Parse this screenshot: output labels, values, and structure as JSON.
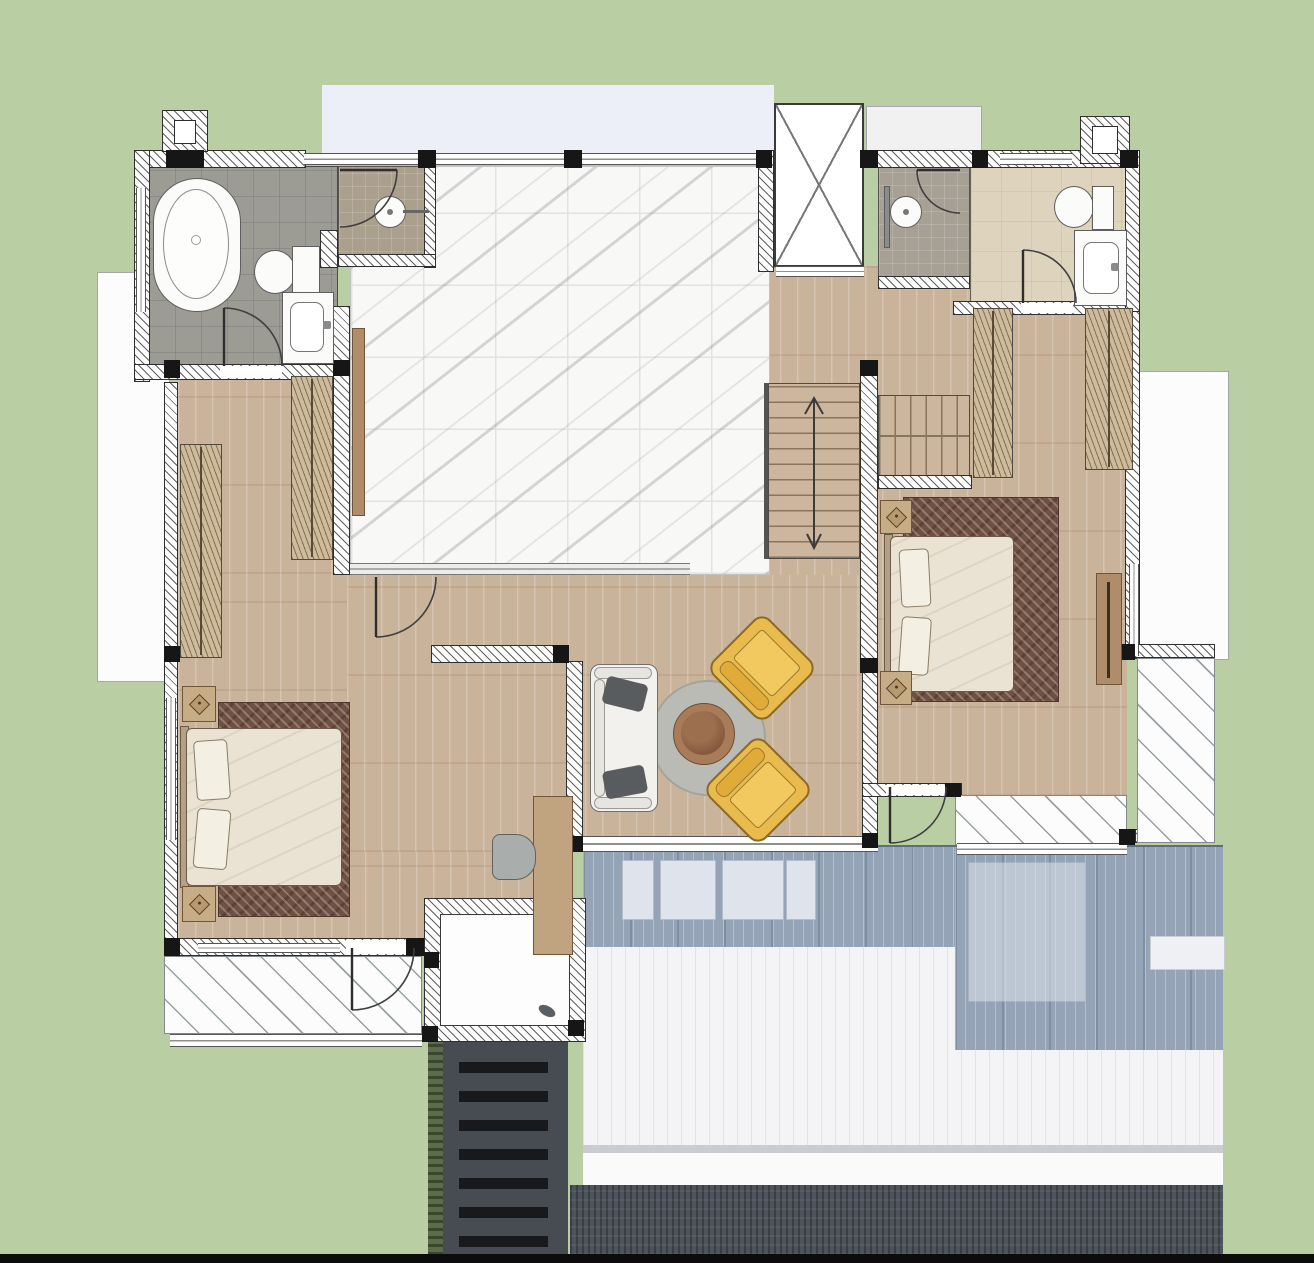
{
  "meta": {
    "type": "architectural-floor-plan",
    "view": "top-down rendered color plan",
    "visible_text": "none",
    "canvas": {
      "width": 1314,
      "height": 1263
    }
  },
  "palette": {
    "background_green": "#b9cea3",
    "pale_roof_lavender": "#edeff8",
    "wood_floor": "#c9b49b",
    "marble_tile": "#f8f8f7",
    "gray_bath_tile": "#9c9c95",
    "tan_shower_tile": "#ab9f8d",
    "beige_bath_floor": "#ded3bc",
    "wall_hatch_line": "#2e2e2e",
    "column_black": "#161616",
    "deck_blue_gray": "#94a4b6",
    "white_roof": "#f4f4f6",
    "dark_roof": "#4d535a",
    "louver_canopy": "#464c52",
    "armchair_yellow": "#e9ba4d",
    "round_rug_gray": "#b9bbb4",
    "coffee_table_brown": "#a87c59",
    "bed_blanket": "#eae3d4",
    "bed_rug_brown": "#6e5144",
    "bottom_bar_black": "#0c0c0c"
  },
  "rooms": [
    {
      "id": "master-bathroom",
      "name": "Master Bathroom",
      "floor": "gray ceramic tile"
    },
    {
      "id": "master-shower",
      "name": "Master Shower",
      "floor": "tan mosaic tile"
    },
    {
      "id": "walk-in-closet",
      "name": "Walk-in Closet",
      "floor": "wood"
    },
    {
      "id": "hall",
      "name": "Marble Hall / Landing",
      "floor": "white marble tile"
    },
    {
      "id": "elevator",
      "name": "Elevator Shaft"
    },
    {
      "id": "shower-room",
      "name": "Shower Room",
      "floor": "tan tile"
    },
    {
      "id": "bathroom-2",
      "name": "Bathroom 2",
      "floor": "beige tile"
    },
    {
      "id": "wardrobe-corridor",
      "name": "Wardrobe Corridor",
      "floor": "wood"
    },
    {
      "id": "staircase",
      "name": "Staircase",
      "direction": "up"
    },
    {
      "id": "bedroom-2",
      "name": "Bedroom 2",
      "floor": "wood"
    },
    {
      "id": "family-sitting-area",
      "name": "Family Sitting Area",
      "floor": "wood"
    },
    {
      "id": "master-bedroom",
      "name": "Master Bedroom",
      "floor": "wood"
    },
    {
      "id": "balcony",
      "name": "Balcony (hatched)"
    },
    {
      "id": "terrace",
      "name": "Terrace (hatched)"
    },
    {
      "id": "roof-deck",
      "name": "Lower Roof Deck (blue-gray)"
    },
    {
      "id": "lower-roof",
      "name": "Lower White Roof"
    },
    {
      "id": "dark-roof",
      "name": "Lower Dark Roof"
    },
    {
      "id": "louvered-canopy",
      "name": "Louvered Canopy"
    },
    {
      "id": "roof-opening",
      "name": "Roof Opening / Skylight Room"
    }
  ],
  "fixtures": [
    {
      "id": "bathtub",
      "name": "Freestanding bathtub"
    },
    {
      "id": "toilet-master",
      "name": "Toilet"
    },
    {
      "id": "vanity-master",
      "name": "Vanity sink"
    },
    {
      "id": "shower-head-master",
      "name": "Shower head"
    },
    {
      "id": "toilet-2",
      "name": "Toilet"
    },
    {
      "id": "vanity-2",
      "name": "Vanity sink"
    },
    {
      "id": "shower-head-2",
      "name": "Shower head with grab bar"
    }
  ],
  "furniture": [
    {
      "id": "bed-master",
      "name": "Double bed with pillows"
    },
    {
      "id": "bed-2",
      "name": "Double bed with pillows"
    },
    {
      "id": "nightstands",
      "name": "Nightstands with diamond lamps",
      "count": 4
    },
    {
      "id": "wardrobes",
      "name": "Hanging wardrobes",
      "count": 4
    },
    {
      "id": "sofa",
      "name": "White sofa with dark cushions"
    },
    {
      "id": "round-rug",
      "name": "Round gray rug"
    },
    {
      "id": "coffee-table",
      "name": "Round brown coffee table"
    },
    {
      "id": "armchairs",
      "name": "Yellow armchairs",
      "count": 2
    },
    {
      "id": "hall-console",
      "name": "Hall console"
    },
    {
      "id": "tv-console",
      "name": "TV console"
    },
    {
      "id": "desk",
      "name": "Desk console with chair"
    }
  ]
}
